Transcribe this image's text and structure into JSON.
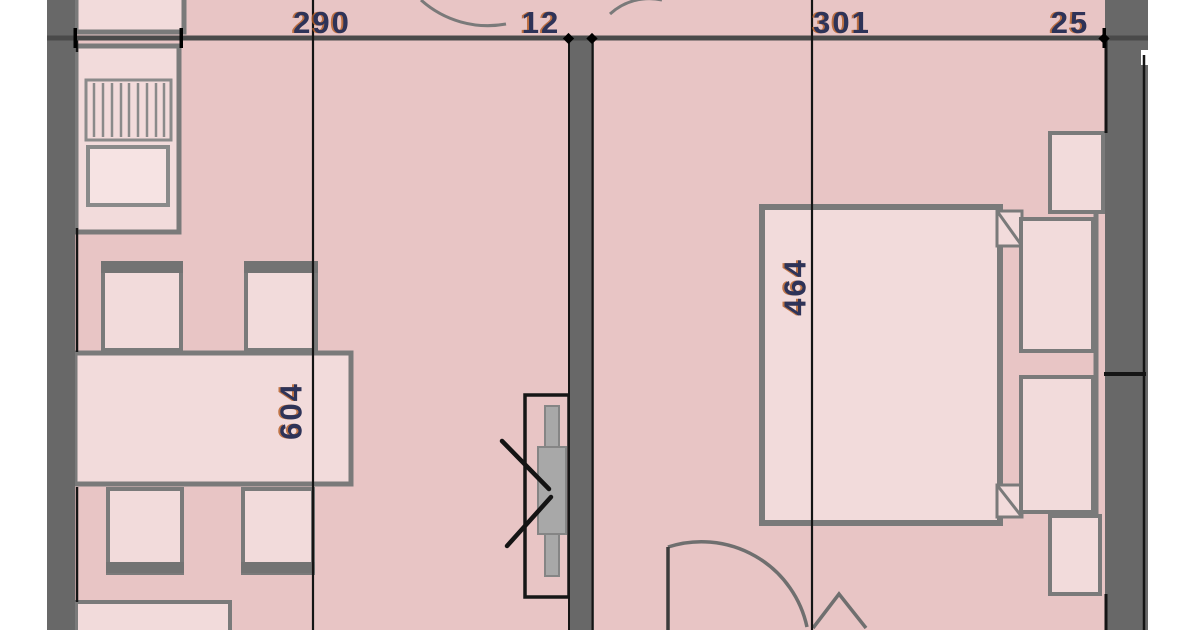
{
  "plan_labels": {
    "top_dimensions": [
      {
        "label": "290"
      },
      {
        "label": "12"
      },
      {
        "label": "301"
      },
      {
        "label": "25"
      }
    ],
    "rotated_dimensions": [
      {
        "label": "604"
      },
      {
        "label": "464"
      }
    ]
  },
  "colors": {
    "background": "#ffffff",
    "floor_fill": "#e8c5c5",
    "furniture_fill": "#f2dbdb",
    "sink_fill": "#f6e3e3",
    "wall_gray": "#686868",
    "furniture_stroke": "#7a7a7a",
    "dimension_line": "#4a4a4a",
    "extension_line": "#141414",
    "duct_fill": "#a8a8a8",
    "label_text": "#2e3358",
    "label_fringe": "#b35a20"
  }
}
